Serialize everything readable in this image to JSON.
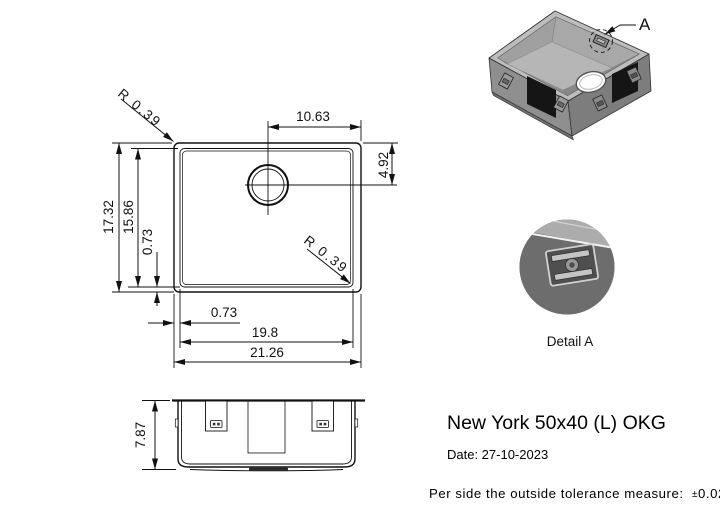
{
  "drawing": {
    "top_view": {
      "outer_width": "21.26",
      "inner_width": "19.8",
      "left_offset": "0.73",
      "outer_height": "17.32",
      "inner_height": "15.86",
      "bottom_offset": "0.73",
      "drain_from_right": "10.63",
      "drain_from_top": "4.92",
      "corner_radius_top_left": "R 0.39",
      "corner_radius_bottom_right": "R 0.39"
    },
    "front_view": {
      "height": "7.87"
    },
    "iso_view": {
      "detail_marker": "A"
    },
    "detail_view": {
      "caption": "Detail A"
    }
  },
  "title_block": {
    "product_name": "New York 50x40 (L) OKG",
    "date": "Date: 27-10-2023",
    "tolerance_label": "Per side the outside tolerance measure:",
    "tolerance_sign": "±",
    "tolerance_value": "0.02 inch"
  },
  "colors": {
    "line": "#111111",
    "sink_wall": "#8c8c8c",
    "sink_rim": "#bdbdbd",
    "sink_interior": "#b6b6b6",
    "pad": "#151515",
    "background": "#ffffff"
  }
}
